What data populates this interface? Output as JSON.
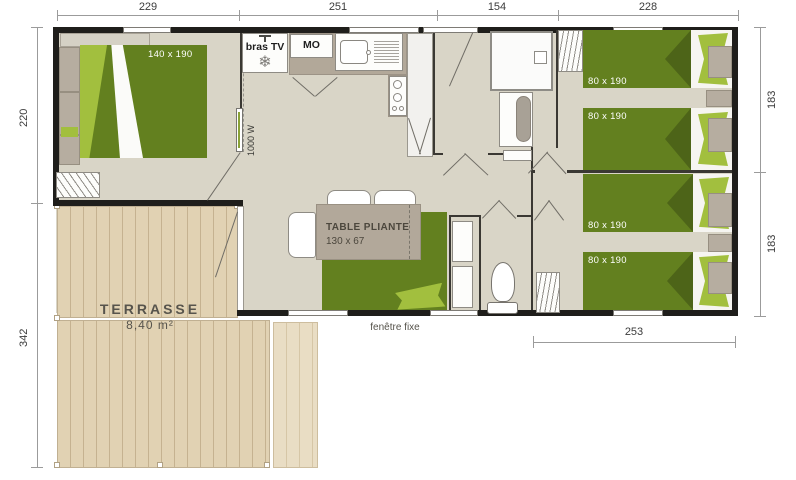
{
  "dims": {
    "top": [
      "229",
      "251",
      "154",
      "228"
    ],
    "left": [
      "220",
      "342"
    ],
    "right": [
      "183",
      "183"
    ],
    "bottom": [
      "253"
    ]
  },
  "rooms": {
    "master_bedroom": {
      "bed_size": "140 x 190",
      "radiator": "1000 W"
    },
    "kitchen": {
      "tv_bracket": "bras TV",
      "microwave": "MO"
    },
    "living": {
      "table_line1": "TABLE PLIANTE",
      "table_line2": "130 x 67"
    },
    "bedrooms": {
      "bed_sizes": [
        "80 x 190",
        "80 x 190",
        "80 x 190",
        "80 x 190"
      ]
    },
    "terrace": {
      "name": "TERRASSE",
      "area": "8,40 m²"
    },
    "window_label": "fenêtre fixe"
  },
  "icons": {
    "fridge_snowflake": "❄"
  },
  "colors": {
    "wall": "#1f1e1b",
    "floor": "#d9d5c7",
    "bed_green": "#63801f",
    "light_green": "#a2bf3e",
    "terrace_wood": "#e1d2b3",
    "furniture_taupe": "#b2a899"
  }
}
